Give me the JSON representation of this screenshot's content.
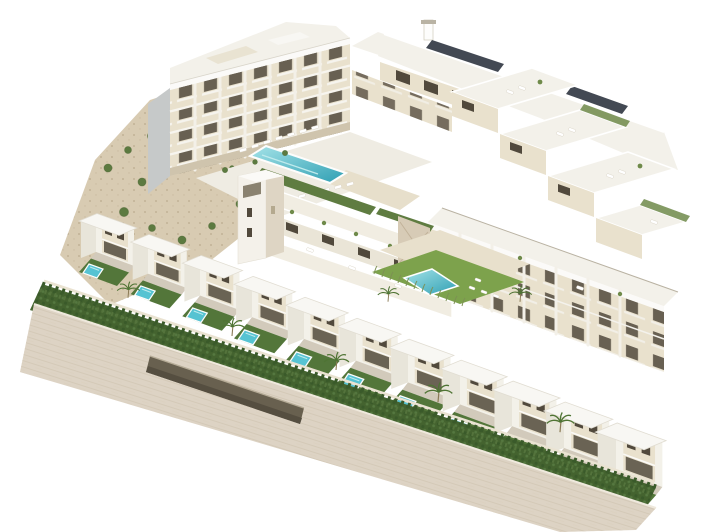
{
  "scene": {
    "type": "aerial-3d-architectural-render",
    "subject": "coastal residential development with white apartment blocks, a rooftop communal pool, terraced apartments, a row of townhouses with private pools, communal garden pool, rocky hillside, front hedges and a stone retaining wall with garage entrance",
    "background": "#ffffff",
    "counts": {
      "townhouse_units": 11,
      "private_pools": 11,
      "communal_pools": 2,
      "apartment_blocks": 4,
      "garage_entrances": 1,
      "elevator_towers": 1
    }
  },
  "colors": {
    "background": "#ffffff",
    "facade_cream": "#e9e1cd",
    "facade_tan": "#d9cdb4",
    "facade_shadow": "#cfc4ad",
    "side_grey": "#c6c9c9",
    "parapet_white": "#fbfaf8",
    "roof_white": "#f3f1ea",
    "window_dark": "#51493c",
    "glass_dark": "#6a6354",
    "pool_aqua": "#56c3d2",
    "pool_light": "#a5e3e8",
    "pool_deep": "#2f9fb3",
    "lawn_bright": "#7da24c",
    "lawn_dark": "#53763a",
    "hedge_green": "#44632f",
    "hedge_dark": "#3a5a2a",
    "terrain_sand": "#d8cbb2",
    "terrain_dot": "#b3a184",
    "bush_green": "#5c7a40",
    "wall_stone": "#ddd3c4",
    "wall_shade": "#cbbfa9",
    "garage_dark": "#68604f",
    "solar_panel": "#2f3540"
  }
}
